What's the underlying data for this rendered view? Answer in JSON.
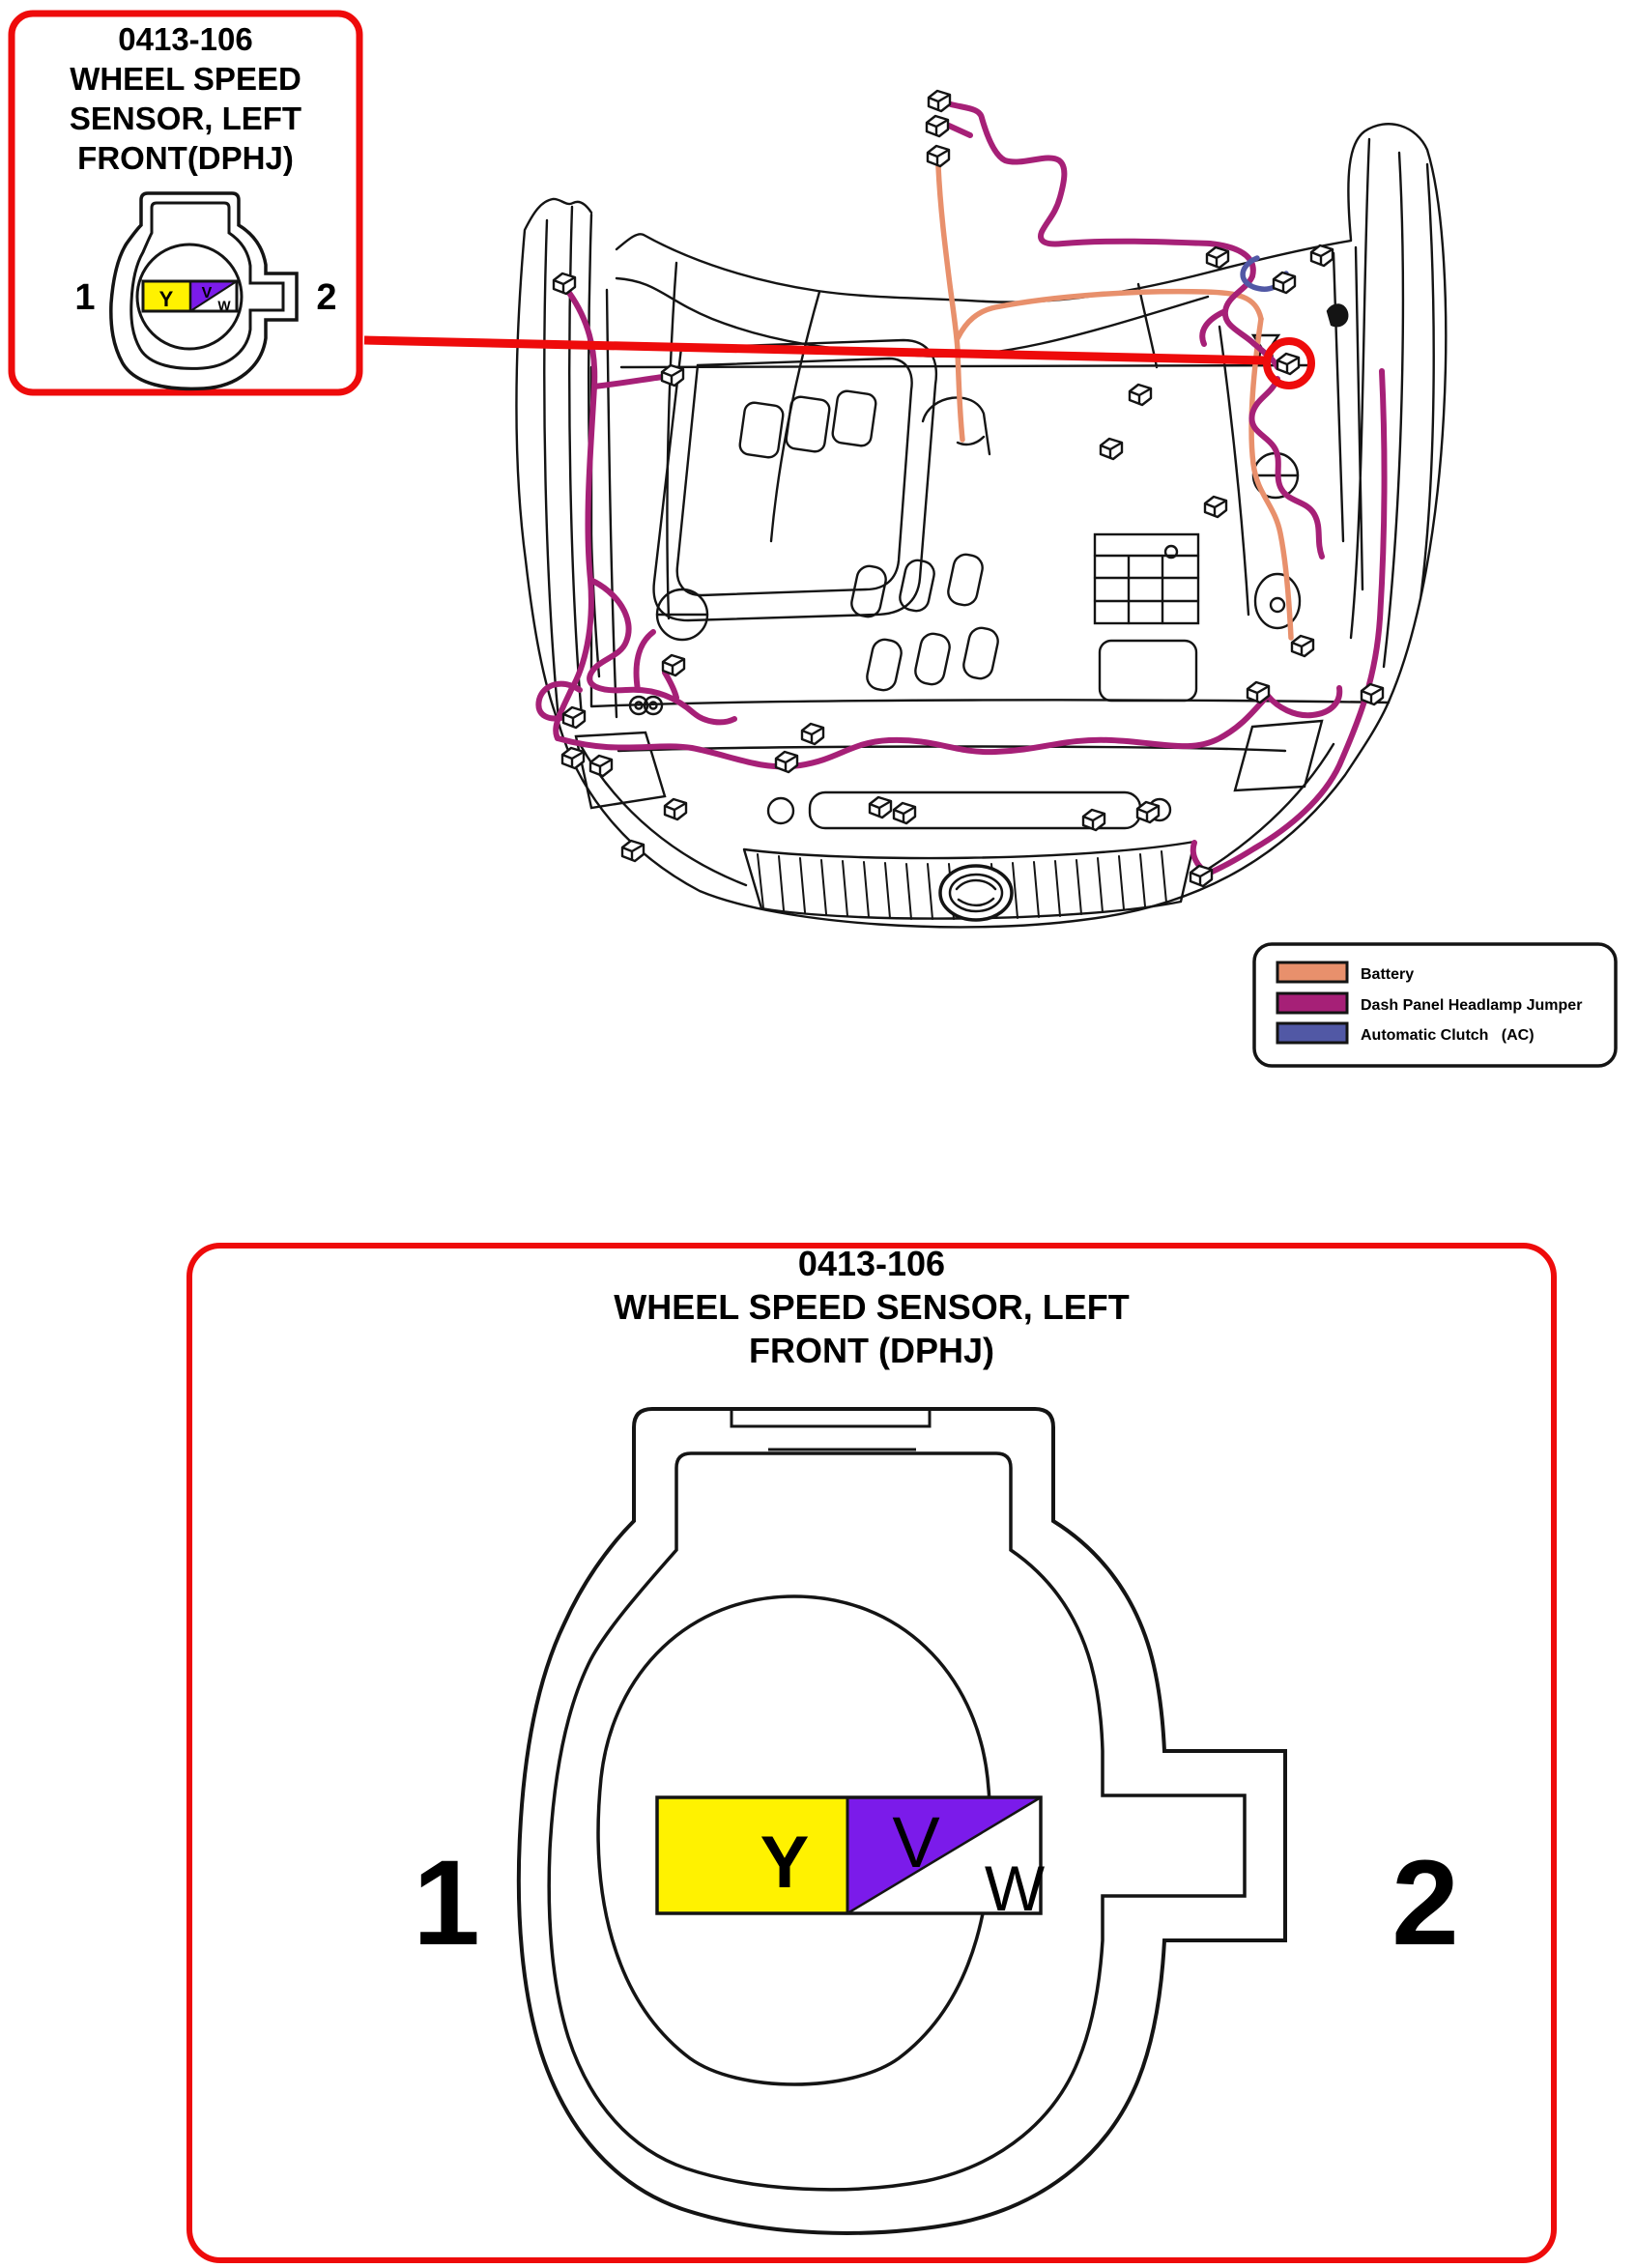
{
  "accent_red": "#EE0B0B",
  "line_black": "#141414",
  "callout_small": {
    "code": "0413-106",
    "title_line1": "WHEEL SPEED",
    "title_line2": "SENSOR, LEFT",
    "title_line3": "FRONT(DPHJ)",
    "pin_left": "1",
    "pin_right": "2",
    "wire_letters": {
      "y": "Y",
      "v": "V",
      "w": "W"
    }
  },
  "callout_large": {
    "code": "0413-106",
    "title_line1": "WHEEL SPEED SENSOR, LEFT",
    "title_line2": "FRONT (DPHJ)",
    "pin_left": "1",
    "pin_right": "2",
    "wire_letters": {
      "y": "Y",
      "v": "V",
      "w": "W"
    }
  },
  "connector_colors": {
    "yellow": "#FFF200",
    "violet": "#7B1BEA",
    "white": "#FFFFFF"
  },
  "legend": {
    "items": [
      {
        "label": "Battery",
        "color": "#E8906C"
      },
      {
        "label": "Dash Panel Headlamp Jumper",
        "color": "#A62077"
      },
      {
        "label": "Automatic Clutch   (AC)",
        "color": "#5158A5"
      }
    ]
  }
}
